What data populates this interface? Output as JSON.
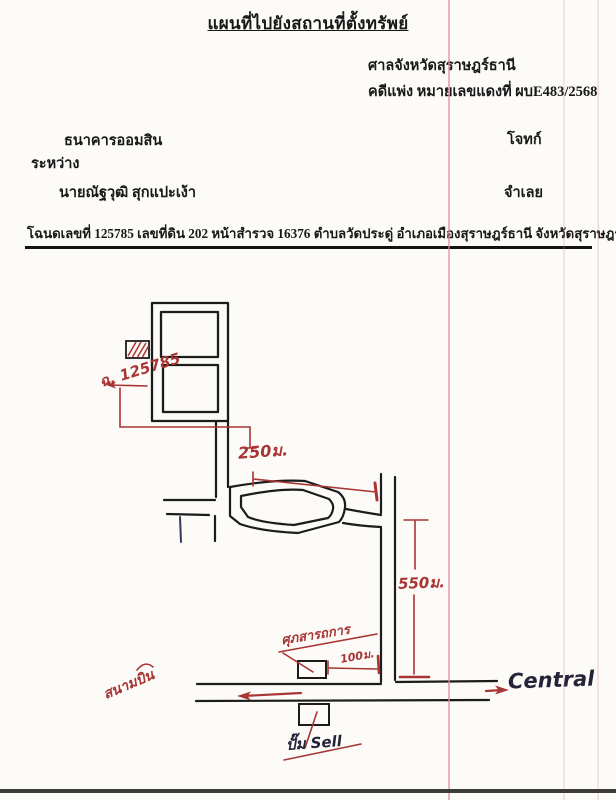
{
  "document": {
    "title": "แผนที่ไปยังสถานที่ตั้งทรัพย์",
    "court": {
      "name": "ศาลจังหวัดสุราษฎร์ธานี",
      "case_line": "คดีแพ่ง  หมายเลขแดงที่ ผบE483/2568"
    },
    "parties": {
      "plaintiff": "ธนาคารออมสิน",
      "plaintiff_role": "โจทก์",
      "between": "ระหว่าง",
      "defendant": "นายณัฐวุฒิ สุกแปะเง้า",
      "defendant_role": "จำเลย"
    },
    "deed_line": "โฉนดเลขที่ 125785  เลขที่ดิน 202  หน้าสำรวจ 16376  ตำบลวัดประดู่  อำเภอเมืองสุราษฎร์ธานี  จังหวัดสุราษฎร์ธานี"
  },
  "map": {
    "labels": {
      "deed_no": "ฉ. 125785",
      "dist_250": "250ม.",
      "dist_550": "550ม.",
      "dist_100": "100ม.",
      "landmark_red": "ศุภสารถการ",
      "airport": "สนามบิน",
      "central": "Central",
      "gas_station": "ปั๊ม Sell"
    },
    "colors": {
      "ink": "#1c1c1c",
      "red_ink": "#a83434",
      "blue_ink": "#323d5c",
      "scan_line_pink": "#e089a8"
    }
  }
}
